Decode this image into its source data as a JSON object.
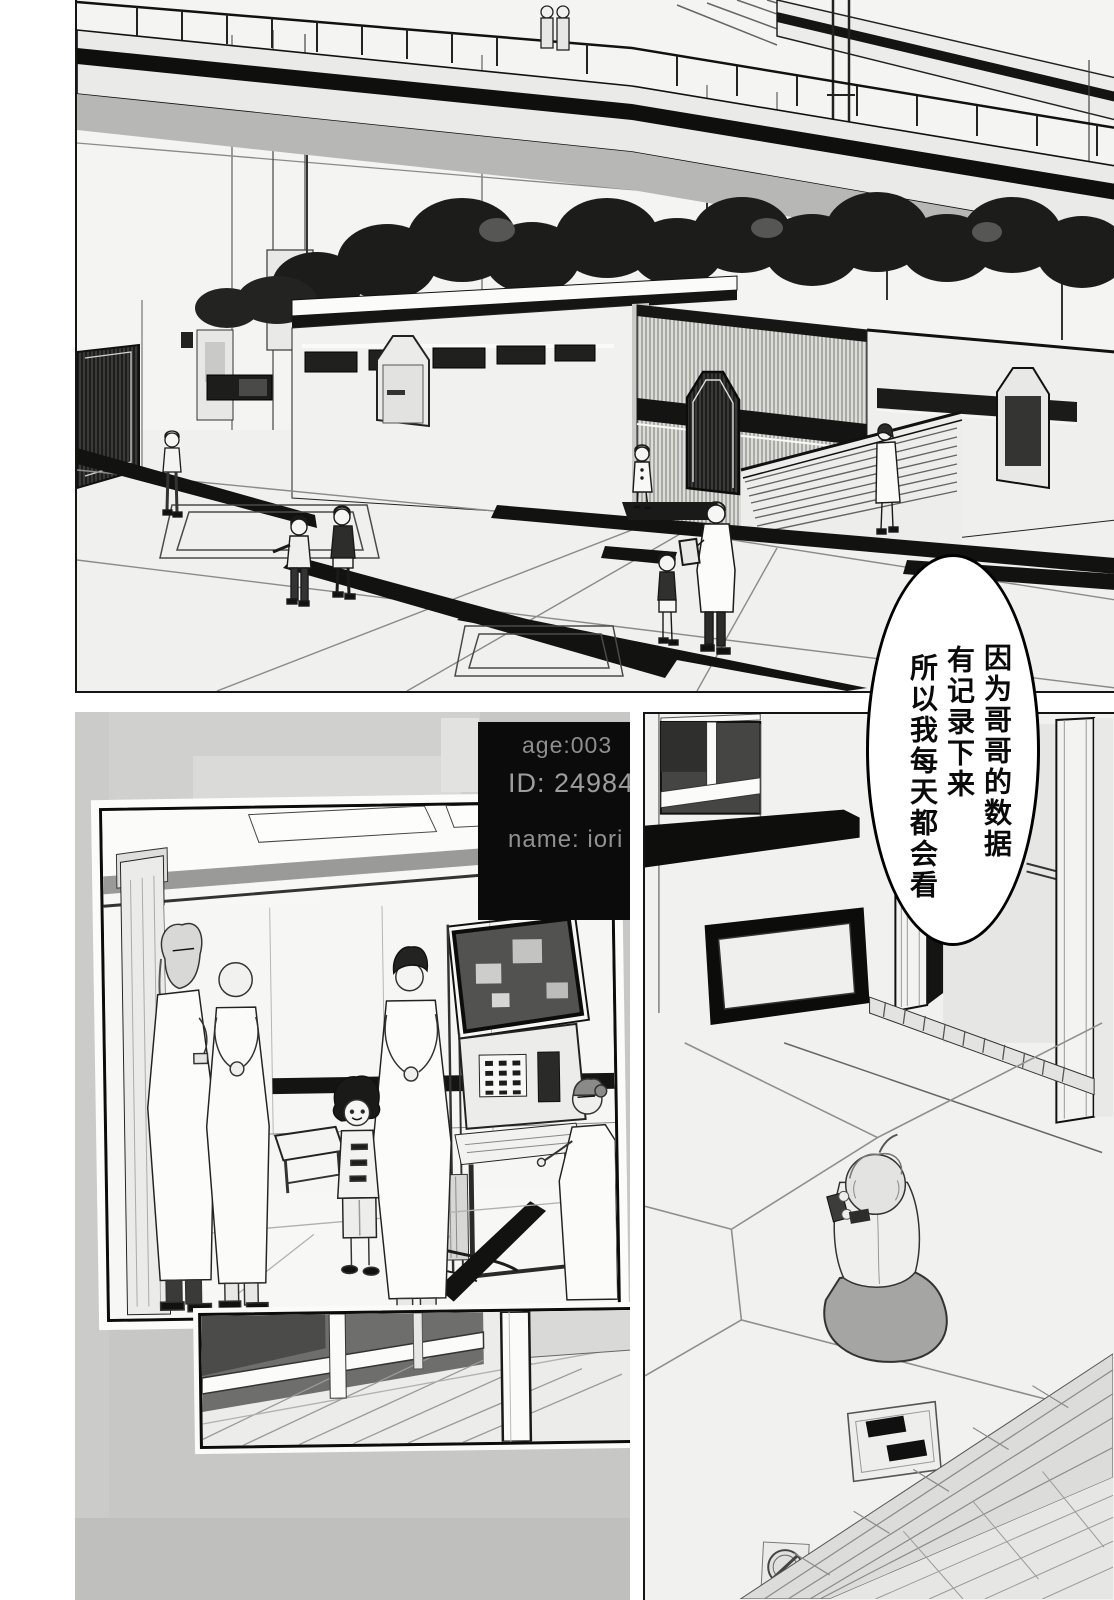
{
  "colors": {
    "ink": "#111111",
    "paper": "#ffffff",
    "halftone_gray": "#c7c7c5",
    "screen_bg": "#0b0b0b",
    "screen_text": "#989898"
  },
  "speech_bubble": {
    "col_right": "因为哥哥的数据",
    "col_middle": "有记录下来",
    "col_left": "所以我每天都会看"
  },
  "monitor": {
    "line_age": "age:003",
    "line_id": "ID: 249842",
    "line_name": "name: iori"
  }
}
